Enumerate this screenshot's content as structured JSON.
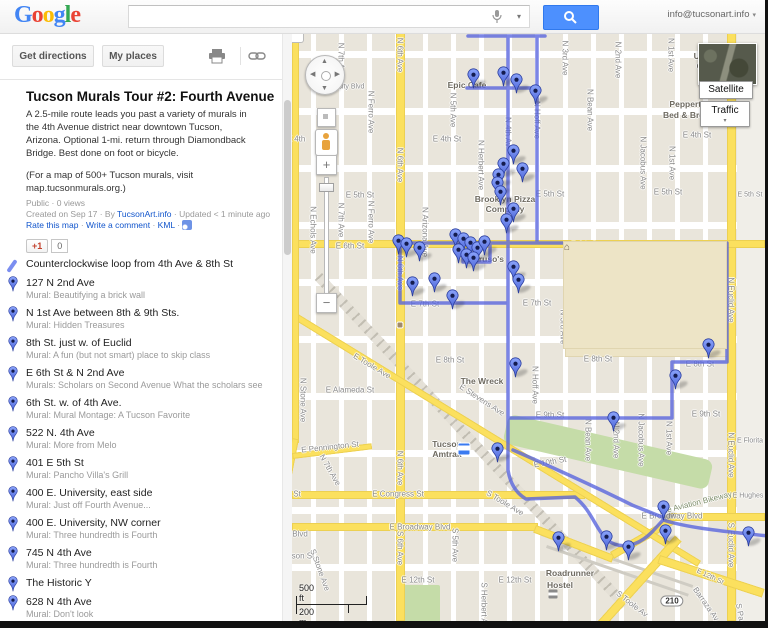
{
  "header": {
    "logo": [
      [
        "G",
        "#4285F4"
      ],
      [
        "o",
        "#EA4335"
      ],
      [
        "o",
        "#FBBC05"
      ],
      [
        "g",
        "#4285F4"
      ],
      [
        "l",
        "#34A853"
      ],
      [
        "e",
        "#EA4335"
      ]
    ],
    "search_value": "",
    "account_email": "info@tucsonart.info"
  },
  "toolbar": {
    "get_directions": "Get directions",
    "my_places": "My places"
  },
  "glyphs": {
    "caret_down": "▾",
    "collapse_left": "◀",
    "north": "▲",
    "south": "▼",
    "west": "◀",
    "east": "▶",
    "plus": "+",
    "minus": "−",
    "school": "⌂"
  },
  "sidebar": {
    "title": "Tucson Murals Tour #2: Fourth Avenue",
    "description": "A 2.5-mile route leads you past a variety of murals in\nthe 4th Avenue district near downtown Tucson,\nArizona. Optional 1-mi. return through Diamondback\nBridge. Best done on foot or bicycle.",
    "note": "(For a map of 500+ Tucson murals, visit\nmap.tucsonmurals.org.)",
    "meta1": "Public · 0 views",
    "meta2_prefix": "Created on Sep 17 · By ",
    "author": "TucsonArt.info",
    "meta2_suffix": " · Updated < 1 minute ago",
    "links": {
      "rate": "Rate this map",
      "comment": "Write a comment",
      "kml": "KML"
    },
    "plusone": {
      "label": "+1",
      "count": "0"
    },
    "items": [
      {
        "type": "line",
        "title": "Counterclockwise loop from 4th Ave & 8th St",
        "subtitle": ""
      },
      {
        "type": "pin",
        "title": "127 N 2nd Ave",
        "subtitle": "Mural: Beautifying a brick wall"
      },
      {
        "type": "pin",
        "title": "N 1st Ave between 8th & 9th Sts.",
        "subtitle": "Mural: Hidden Treasures"
      },
      {
        "type": "pin",
        "title": "8th St. just w. of Euclid",
        "subtitle": "Mural: A fun (but not smart) place to skip class"
      },
      {
        "type": "pin",
        "title": "E 6th St & N 2nd Ave",
        "subtitle": "Murals: Scholars on Second Avenue What the scholars see"
      },
      {
        "type": "pin",
        "title": "6th St. w. of 4th Ave.",
        "subtitle": "Mural: Mural Montage: A Tucson Favorite"
      },
      {
        "type": "pin",
        "title": "522 N. 4th Ave",
        "subtitle": "Mural: More from Melo"
      },
      {
        "type": "pin",
        "title": "401 E 5th St",
        "subtitle": "Mural: Pancho Villa's Grill"
      },
      {
        "type": "pin",
        "title": "400 E. University, east side",
        "subtitle": "Mural: Just off Fourth Avenue..."
      },
      {
        "type": "pin",
        "title": "400 E. University, NW corner",
        "subtitle": "Mural: Three hundredth is Fourth"
      },
      {
        "type": "pin",
        "title": "745 N 4th Ave",
        "subtitle": "Mural: Three hundredth is Fourth"
      },
      {
        "type": "pin",
        "title": "The Historic Y",
        "subtitle": ""
      },
      {
        "type": "pin",
        "title": "628 N 4th Ave",
        "subtitle": "Mural: Don't look"
      },
      {
        "type": "pin",
        "title": "622 N 4th Ave",
        "subtitle": ""
      }
    ]
  },
  "map": {
    "buttons": {
      "satellite": "Satellite",
      "traffic": "Traffic"
    },
    "scale": {
      "ft": "500 ft",
      "m": "200 m"
    },
    "route": {
      "color": "#5663de",
      "paths": [
        "M176 3 H253 M175 55 H245 M216 3 V437 M245 3 V210 M106 210 H435 M108 210 V270 H216 M171 210 V229 H198 V210 M435 210 V329 H380 V385 H216 M216 437 C218 450 224 460 234 466 L283 464 C300 478 303 495 315 507 C330 518 347 512 360 499 L371 487 C400 496 440 499 476 503",
        "M221 417 C255 432 300 452 340 472 L370 484"
      ]
    },
    "markers": [
      [
        473,
        76
      ],
      [
        503,
        74
      ],
      [
        516,
        81
      ],
      [
        535,
        92
      ],
      [
        513,
        152
      ],
      [
        503,
        165
      ],
      [
        522,
        170
      ],
      [
        498,
        176
      ],
      [
        497,
        184
      ],
      [
        500,
        193
      ],
      [
        513,
        210
      ],
      [
        506,
        221
      ],
      [
        398,
        242
      ],
      [
        406,
        245
      ],
      [
        419,
        249
      ],
      [
        455,
        236
      ],
      [
        463,
        240
      ],
      [
        470,
        244
      ],
      [
        477,
        249
      ],
      [
        484,
        243
      ],
      [
        458,
        251
      ],
      [
        466,
        256
      ],
      [
        473,
        259
      ],
      [
        434,
        280
      ],
      [
        412,
        284
      ],
      [
        452,
        297
      ],
      [
        513,
        268
      ],
      [
        518,
        281
      ],
      [
        515,
        365
      ],
      [
        497,
        450
      ],
      [
        708,
        346
      ],
      [
        675,
        377
      ],
      [
        613,
        419
      ],
      [
        663,
        508
      ],
      [
        665,
        532
      ],
      [
        628,
        548
      ],
      [
        606,
        538
      ],
      [
        558,
        539
      ],
      [
        748,
        534
      ]
    ],
    "icons": [
      {
        "type": "school",
        "x": 645,
        "y": 295
      },
      {
        "type": "food",
        "x": 400,
        "y": 325
      },
      {
        "type": "food",
        "x": 470,
        "y": 258
      },
      {
        "type": "train",
        "x": 464,
        "y": 449
      },
      {
        "type": "bed",
        "x": 553,
        "y": 594
      }
    ],
    "labels": [
      [
        "E University Blvd",
        338,
        87,
        0,
        "sm"
      ],
      [
        "E 4th",
        296,
        139
      ],
      [
        "E 4th St",
        447,
        139
      ],
      [
        "E 4th St",
        697,
        135
      ],
      [
        "E 5th St",
        360,
        195
      ],
      [
        "E 5th St",
        550,
        194
      ],
      [
        "E 5th St",
        668,
        192
      ],
      [
        "E 5th St",
        750,
        195,
        0,
        "sm"
      ],
      [
        "E 6th St",
        350,
        246
      ],
      [
        "E 6th St",
        585,
        245
      ],
      [
        "E 6th St",
        690,
        249
      ],
      [
        "E 7th St",
        425,
        304
      ],
      [
        "E 7th St",
        537,
        303
      ],
      [
        "E 8th St",
        450,
        360
      ],
      [
        "E 8th St",
        598,
        359
      ],
      [
        "E 8th St",
        700,
        364
      ],
      [
        "E 9th St",
        550,
        415
      ],
      [
        "E 9th St",
        706,
        414
      ],
      [
        "E 10th St",
        550,
        462,
        -10
      ],
      [
        "E 12th St",
        418,
        580
      ],
      [
        "E 12th St",
        515,
        580
      ],
      [
        "E 12th St",
        710,
        577,
        25,
        "sm"
      ],
      [
        "E Congress St",
        398,
        494
      ],
      [
        "E Broadway Blvd",
        420,
        527
      ],
      [
        "E Broadway Blvd",
        672,
        516
      ],
      [
        "E Alameda St",
        350,
        390
      ],
      [
        "E Pennington St",
        330,
        447,
        -6
      ],
      [
        "son St",
        303,
        556
      ],
      [
        "St",
        297,
        494
      ],
      [
        "Blvd",
        300,
        534
      ],
      [
        "E Florita",
        750,
        441,
        0,
        "sm"
      ],
      [
        "E Hughes",
        748,
        496,
        0,
        "sm"
      ],
      [
        "E Toole Ave",
        372,
        366,
        31
      ],
      [
        "S Toole Ave",
        505,
        503,
        31
      ],
      [
        "S Toole Av",
        632,
        604,
        38
      ],
      [
        "E Stevens Ave",
        482,
        400,
        33
      ],
      [
        "The Aviation Bikeway",
        695,
        503,
        -14,
        "grn"
      ],
      [
        "Barraza Av",
        706,
        604,
        55
      ],
      [
        "S Pa",
        740,
        612,
        80
      ],
      [
        "210",
        672,
        601,
        0,
        "shield"
      ],
      [
        "N Stone Ave",
        303,
        400,
        90
      ],
      [
        "S Stone Ave",
        320,
        570,
        70
      ],
      [
        "N Echols Ave",
        313,
        230,
        90
      ],
      [
        "N 7th Ave",
        341,
        60,
        90
      ],
      [
        "N 7th Ave",
        341,
        220,
        90
      ],
      [
        "N 7th Ave",
        330,
        470,
        60
      ],
      [
        "N Ferro Ave",
        371,
        112,
        90
      ],
      [
        "N Ferro Ave",
        371,
        222,
        90
      ],
      [
        "N 6th Ave",
        400,
        55,
        90
      ],
      [
        "N 6th Ave",
        400,
        165,
        90
      ],
      [
        "N 6th Ave",
        400,
        273,
        90
      ],
      [
        "N 6th Ave",
        400,
        468,
        90
      ],
      [
        "S 6th Ave",
        400,
        548,
        90
      ],
      [
        "N 5th Ave",
        453,
        110,
        90
      ],
      [
        "S 5th Ave",
        455,
        545,
        90
      ],
      [
        "N Herbert Ave",
        481,
        165,
        90
      ],
      [
        "S Herbert A",
        484,
        603,
        90
      ],
      [
        "N 4th Av",
        508,
        132,
        90
      ],
      [
        "N Hoff Ave",
        537,
        120,
        90
      ],
      [
        "N Hoff Ave",
        535,
        385,
        90
      ],
      [
        "N Arizona Ave",
        425,
        232,
        90
      ],
      [
        "N 3rd Ave",
        565,
        58,
        90
      ],
      [
        "N 3rd Ave",
        563,
        327,
        90
      ],
      [
        "N 2nd Ave",
        618,
        60,
        90
      ],
      [
        "N 2nd Ave",
        616,
        440,
        90
      ],
      [
        "N Bean Ave",
        590,
        110,
        90
      ],
      [
        "N Bean Ave",
        588,
        440,
        90
      ],
      [
        "N Jacobus Ave",
        643,
        163,
        90
      ],
      [
        "N Jacobus Ave",
        641,
        440,
        90
      ],
      [
        "N 1st Ave",
        671,
        55,
        90
      ],
      [
        "N 1st Ave",
        672,
        163,
        90
      ],
      [
        "N 1st Ave",
        669,
        438,
        90
      ],
      [
        "N Euclid Ave",
        731,
        300,
        90
      ],
      [
        "N Euclid Ave",
        731,
        455,
        90
      ],
      [
        "S Euclid Ave",
        731,
        545,
        90
      ],
      [
        "Epic Cafe",
        467,
        85,
        0,
        "poi"
      ],
      [
        "Brooklyn Pizza",
        505,
        199,
        0,
        "poi"
      ],
      [
        "Company",
        505,
        209,
        0,
        "poi"
      ],
      [
        "Caruso's",
        486,
        259,
        0,
        "poi"
      ],
      [
        "The Wreck",
        482,
        381,
        0,
        "poi"
      ],
      [
        "Tucson",
        447,
        444,
        0,
        "poi"
      ],
      [
        "Amtrak",
        447,
        454,
        0,
        "poi"
      ],
      [
        "Tucson High",
        648,
        307,
        0,
        "sch"
      ],
      [
        "Magnet School",
        648,
        320,
        0,
        "sch"
      ],
      [
        "Peppertrees",
        694,
        104,
        0,
        "poi"
      ],
      [
        "Bed & Breakfa",
        692,
        115,
        0,
        "poi"
      ],
      [
        "Ua",
        699,
        56,
        0,
        "poi"
      ],
      [
        "Ce",
        702,
        66,
        0,
        "poi"
      ],
      [
        "Roadrunner",
        570,
        573,
        0,
        "poi"
      ],
      [
        "Hostel",
        560,
        585,
        0,
        "poi"
      ]
    ]
  }
}
